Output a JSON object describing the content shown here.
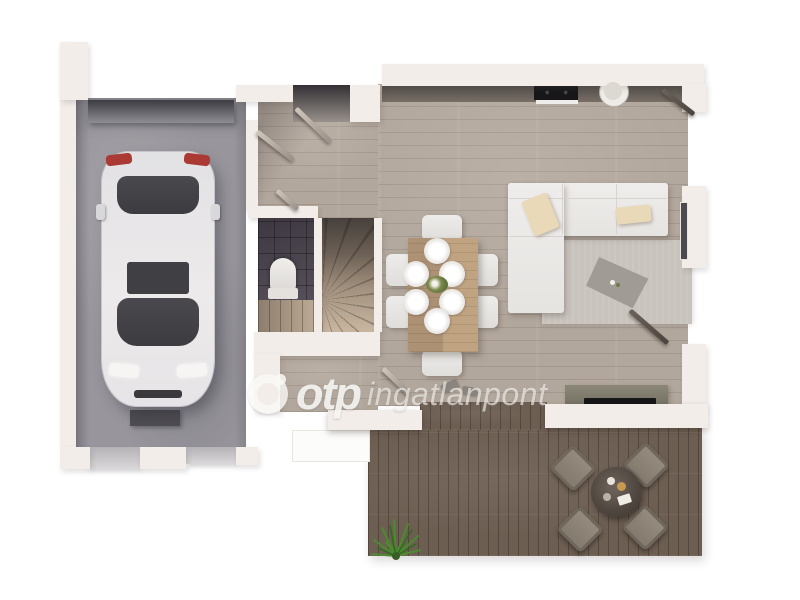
{
  "watermark": {
    "brand": "otp",
    "suffix": "ingatlanpont",
    "logo": "otp-ring-logo"
  },
  "palette": {
    "background": "#ffffff",
    "wall": "#f2ede9",
    "wood_floor": "#b2a79c",
    "garage_floor": "#98969c",
    "deck_wood": "#6d5e52",
    "wc_tile": "#45404a",
    "kitchen_counter": "#5c5550",
    "sofa_white": "#ebe9e7",
    "pillow_beige": "#ead9b9",
    "dining_table_wood": "#b69a7b",
    "car_body": "#e8e6e8",
    "taillight_red": "#aa3a33",
    "plant_green": "#4c8a2f",
    "watermark_text": "rgba(250,249,246,0.8)"
  },
  "scene": {
    "type": "3d-floor-plan-top-view",
    "rooms": [
      {
        "id": "garage",
        "features": [
          "parked-white-car",
          "workbench",
          "two-garage-doors"
        ]
      },
      {
        "id": "entry-hall",
        "features": [
          "front-door-ajar",
          "garage-door-ajar"
        ]
      },
      {
        "id": "wc",
        "features": [
          "toilet",
          "dark-tiles"
        ]
      },
      {
        "id": "staircase",
        "features": [
          "winder-stairs"
        ]
      },
      {
        "id": "storage",
        "features": []
      },
      {
        "id": "living-kitchen",
        "features": [
          "kitchen-counter",
          "cooktop",
          "round-sink",
          "dining-table-6-chairs",
          "l-shaped-sofa",
          "rug",
          "coffee-table",
          "tv-console"
        ]
      },
      {
        "id": "terrace",
        "features": [
          "round-patio-table",
          "four-wicker-chairs",
          "ornamental-grass-plant"
        ]
      }
    ]
  }
}
